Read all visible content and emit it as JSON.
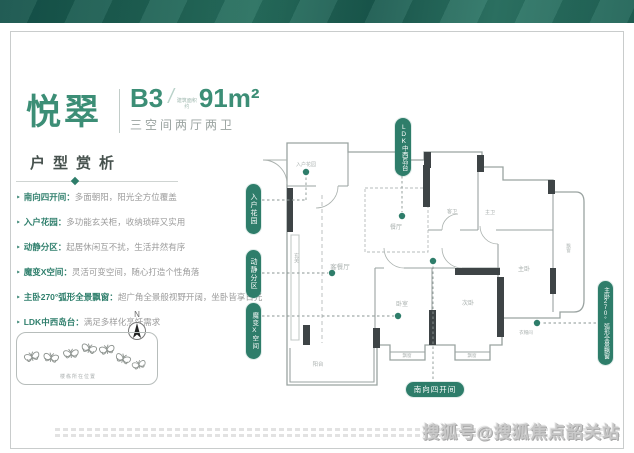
{
  "brand": {
    "accent": "#2e7d6a",
    "title_green": "#3c8e76",
    "band_dark": "#14524a",
    "band_light": "#2e7767"
  },
  "header": {
    "project_name": "悦翠",
    "unit": "B3",
    "slash": "/",
    "area_prefix_top": "建筑面积",
    "area_prefix_bottom": "约",
    "area": "91m²",
    "subtitle": "三空间两厅两卫"
  },
  "section": {
    "title": "户型赏析"
  },
  "ui": {
    "bullet": "‣"
  },
  "features": [
    {
      "label": "南向四开间：",
      "desc": "多面朝阳，阳光全方位覆盖"
    },
    {
      "label": "入户花园：",
      "desc": "多功能玄关柜，收纳琐碎又实用"
    },
    {
      "label": "动静分区：",
      "desc": "起居休闲互不扰，生活井然有序"
    },
    {
      "label": "魔变X空间：",
      "desc": "灵活可变空间，随心打造个性角落"
    },
    {
      "label": "主卧270°弧形全景飘窗：",
      "desc": "超广角全景般视野开阔，坐卧皆享日光"
    },
    {
      "label": "LDK中西岛台：",
      "desc": "满足多样化烹饪需求"
    }
  ],
  "compass": {
    "label": "N"
  },
  "location": {
    "caption": "楼栋所在位置"
  },
  "floorplan": {
    "bubbles": {
      "entry": "入户花园",
      "quiet": "动静分区",
      "magic": "魔变X空间",
      "ldk": "LDK中西岛台",
      "master": "主卧270°弧形全景飘窗",
      "south": "南向四开间"
    },
    "rooms": [
      {
        "label": "入户花园"
      },
      {
        "label": "餐厅"
      },
      {
        "label": "客卫"
      },
      {
        "label": "主卫"
      },
      {
        "label": "客餐厅"
      },
      {
        "label": "玄关"
      },
      {
        "label": "卧室"
      },
      {
        "label": "次卧"
      },
      {
        "label": "主卧"
      },
      {
        "label": "衣帽间"
      },
      {
        "label": "阳台"
      },
      {
        "label": "飘窗"
      },
      {
        "label": "飘窗"
      },
      {
        "label": "飘窗"
      }
    ]
  },
  "watermark": {
    "text": "搜狐号@搜狐焦点韶关站"
  }
}
